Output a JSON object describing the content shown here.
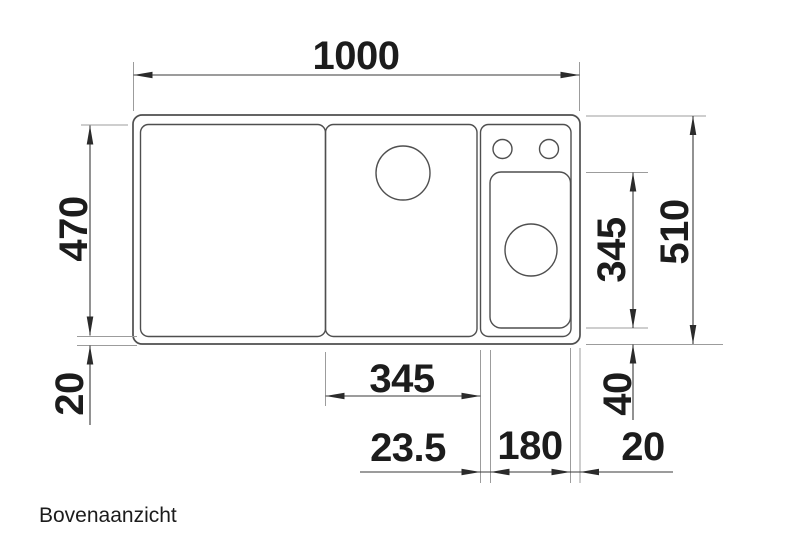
{
  "caption": "Bovenaanzicht",
  "dimensions": {
    "overall_width": "1000",
    "inner_depth": "470",
    "rim_bottom_left": "20",
    "overall_depth": "510",
    "bowl_depth": "345",
    "bowl_offset_bottom": "40",
    "board_width": "345",
    "board_to_bowl_gap": "23.5",
    "bowl_width": "180",
    "rim_right": "20"
  },
  "colors": {
    "outline": "#4f4f4f",
    "dimension_line": "#3a3a3a",
    "extension_line": "#9c9c9c",
    "label_text": "#1c1c1c",
    "background": "#ffffff"
  }
}
